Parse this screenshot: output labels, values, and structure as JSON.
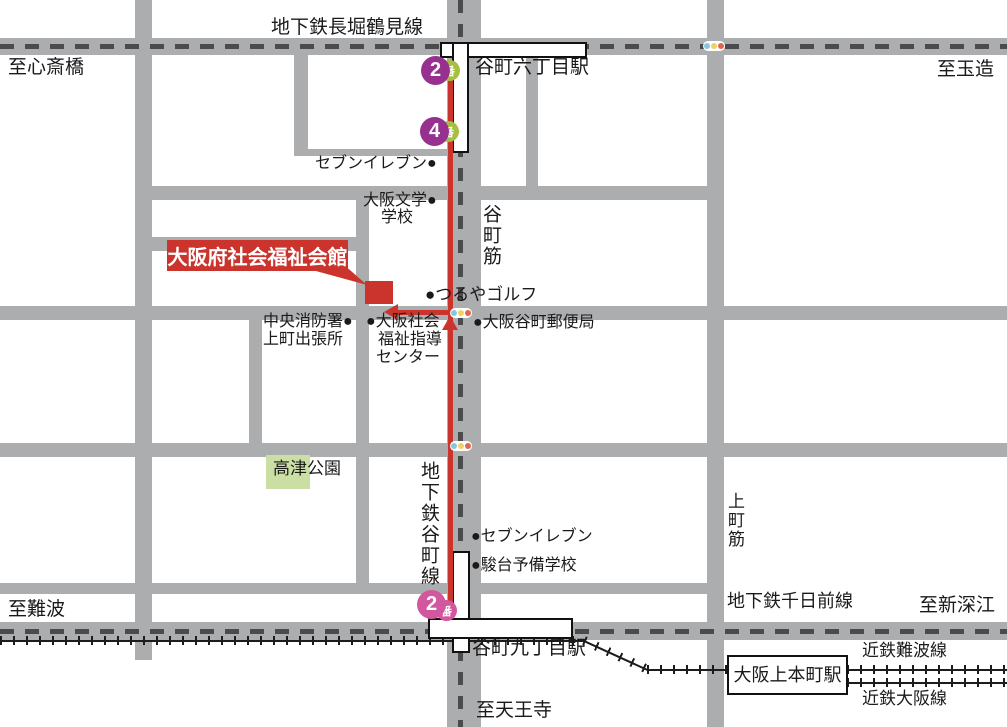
{
  "title": "大阪府社会福祉会館 周辺地図",
  "destination": {
    "name": "大阪府社会福祉会館"
  },
  "lines": {
    "nagahori": "地下鉄長堀鶴見線",
    "sennichimae": "地下鉄千日前線",
    "tanimachi_line": "地下鉄谷町線",
    "kintetsu_namba": "近鉄難波線",
    "kintetsu_osaka": "近鉄大阪線"
  },
  "streets": {
    "tanimachi_suji": "谷町筋",
    "uemachi_suji": "上町筋"
  },
  "stations": {
    "tanimachi6": "谷町六丁目駅",
    "tanimachi9": "谷町九丁目駅",
    "uehommachi": "大阪上本町駅"
  },
  "directions": {
    "shinsaibashi": "至心斎橋",
    "tamatsukuri": "至玉造",
    "namba": "至難波",
    "shinfukae": "至新深江",
    "tennoji": "至天王寺"
  },
  "exits": {
    "top2": {
      "number": "2",
      "suffix": "番"
    },
    "top4": {
      "number": "4",
      "suffix": "番"
    },
    "bottom2": {
      "number": "2",
      "suffix": "番"
    }
  },
  "landmarks": {
    "seven_eleven_top": "セブンイレブン●",
    "bungaku_line1": "大阪文学●",
    "bungaku_line2": "学校",
    "tsuruya_golf": "●つるやゴルフ",
    "fire_station_line1": "中央消防署●",
    "fire_station_line2": "上町出張所",
    "welfare_center_line1": "●大阪社会",
    "welfare_center_line2": "福祉指導",
    "welfare_center_line3": "センター",
    "post_office": "●大阪谷町郵便局",
    "kozu_park": "高津公園",
    "seven_eleven_bottom": "●セブンイレブン",
    "sundai_school": "●駿台予備学校"
  },
  "colors": {
    "road_gray": "#acadaf",
    "subway_dash": "#4b4b4d",
    "route_red": "#cb342d",
    "park_green": "#cbdfa4",
    "exit_purple": "#97308f",
    "exit_green": "#a6bf3e",
    "exit_pink": "#d2579e",
    "signal_blue": "#8ac6da",
    "signal_yellow": "#f0d168",
    "signal_red": "#df674e",
    "railway_black": "#1c1c1c"
  }
}
